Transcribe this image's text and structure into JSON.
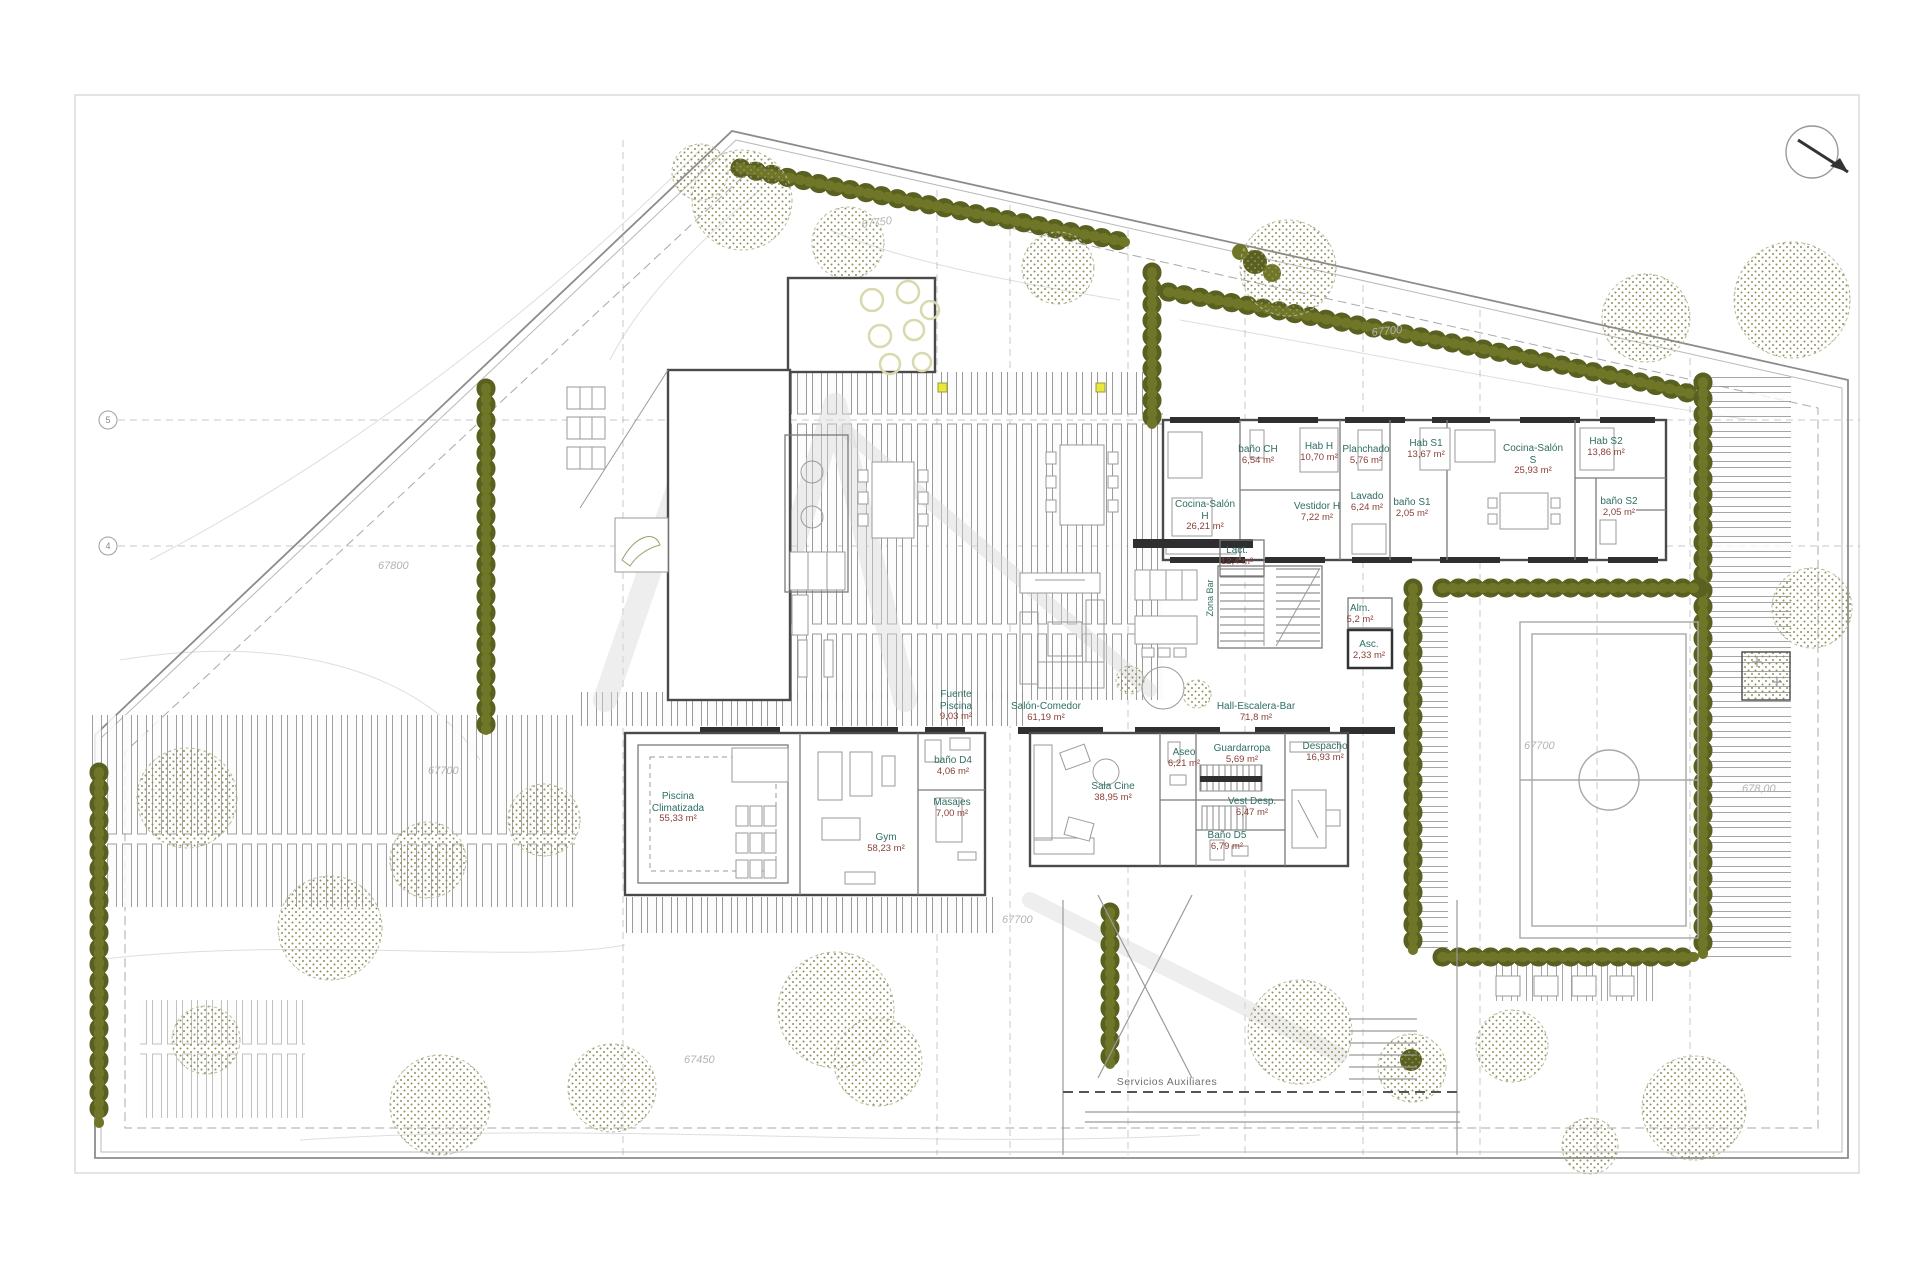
{
  "colors": {
    "hedge": "#5a6020",
    "canopy_dots": "#90905c",
    "room_name": "#2e6e62",
    "room_area": "#8a4038",
    "wall": "#4a4a4a",
    "marker_yellow": "#e8e838"
  },
  "labels": {
    "rooms": [
      {
        "name": "Cocina-Salón H",
        "area": "26,21 m²"
      },
      {
        "name": "baño CH",
        "area": "6,54 m²"
      },
      {
        "name": "Hab H",
        "area": "10,70 m²"
      },
      {
        "name": "Vestidor H",
        "area": "7,22 m²"
      },
      {
        "name": "Planchado",
        "area": "5,76 m²"
      },
      {
        "name": "Lavado",
        "area": "6,24 m²"
      },
      {
        "name": "Hab S1",
        "area": "13,67 m²"
      },
      {
        "name": "baño S1",
        "area": "2,05 m²"
      },
      {
        "name": "Cocina-Salón S",
        "area": "25,93 m²"
      },
      {
        "name": "Hab S2",
        "area": "13,86 m²"
      },
      {
        "name": "baño S2",
        "area": "2,05 m²"
      },
      {
        "name": "Lact.",
        "area": "12,4 m²"
      },
      {
        "name": "Salón-Comedor",
        "area": "61,19 m²"
      },
      {
        "name": "Hall-Escalera-Bar",
        "area": "71,8 m²"
      },
      {
        "name": "Asc.",
        "area": "2,33 m²"
      },
      {
        "name": "Alm.",
        "area": "5,2 m²"
      },
      {
        "name": "Fuente Piscina",
        "area": "9,03 m²"
      },
      {
        "name": "Piscina Climatizada",
        "area": "55,33 m²"
      },
      {
        "name": "Gym",
        "area": "58,23 m²"
      },
      {
        "name": "baño D4",
        "area": "4,06 m²"
      },
      {
        "name": "Masajes",
        "area": "7,00 m²"
      },
      {
        "name": "Sala Cine",
        "area": "38,95 m²"
      },
      {
        "name": "Aseo",
        "area": "6,21 m²"
      },
      {
        "name": "Guardarropa",
        "area": "5,69 m²"
      },
      {
        "name": "Despacho",
        "area": "16,93 m²"
      },
      {
        "name": "Vest Desp.",
        "area": "6,47 m²"
      },
      {
        "name": "Baño D5",
        "area": "6,79 m²"
      }
    ],
    "special": {
      "zona_bar": "Zona Bar",
      "servicios_auxiliares": "Servicios Auxiliares"
    },
    "elevations": [
      "67750",
      "67700",
      "67800",
      "67700",
      "67700",
      "67700",
      "678,00",
      "67450"
    ],
    "grid_bubbles": [
      "5",
      "4"
    ]
  }
}
